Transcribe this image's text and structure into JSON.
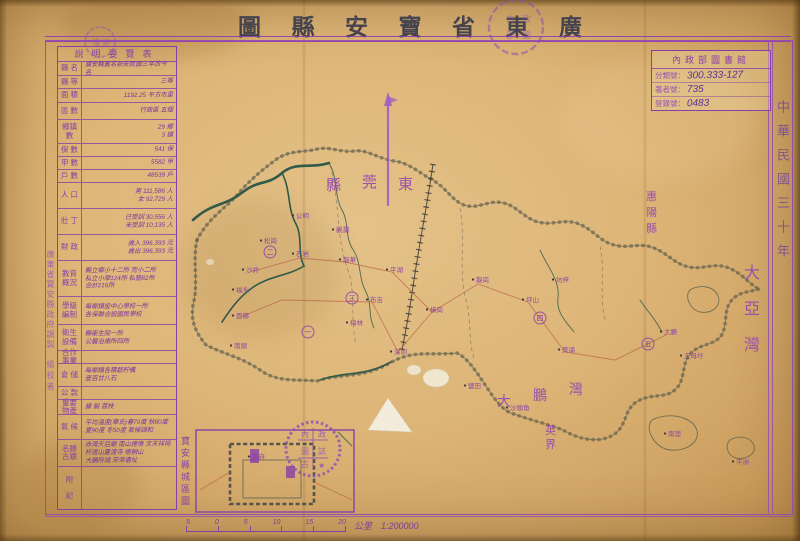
{
  "title": {
    "reading": "廣東省寶安縣圖",
    "display_chars": [
      "圖",
      "縣",
      "安",
      "寶",
      "省",
      "東",
      "廣"
    ]
  },
  "library_card": {
    "header": "內政部圖書館",
    "fields": [
      {
        "label": "分類號：",
        "value": "300.333-127"
      },
      {
        "label": "著者號：",
        "value": "735"
      },
      {
        "label": "登錄號：",
        "value": "0483"
      }
    ]
  },
  "right_margin": {
    "date_vertical": "中華民國三十年"
  },
  "left_margin": {
    "maker_vertical": "廣東省寶安縣政府調製",
    "checker_vertical": "繪校者"
  },
  "info_table": {
    "title": "說明要覽表",
    "rows": [
      {
        "label": "縣 名",
        "h": 14,
        "lines": [
          "寶安縣舊名新安民國三年改今名"
        ]
      },
      {
        "label": "縣 等",
        "h": 13,
        "lines": [
          "三等"
        ],
        "align": "right"
      },
      {
        "label": "面 積",
        "h": 14,
        "lines": [
          "1192.25 平方市里"
        ],
        "align": "right"
      },
      {
        "label": "區 數",
        "h": 17,
        "lines": [
          "行政區 五個"
        ],
        "align": "right"
      },
      {
        "label": "鄉鎮\n數",
        "h": 24,
        "lines": [
          "29 鄉",
          "3 鎮"
        ],
        "align": "right"
      },
      {
        "label": "保 數",
        "h": 13,
        "lines": [
          "541 保"
        ],
        "align": "right"
      },
      {
        "label": "甲 數",
        "h": 13,
        "lines": [
          "5582 甲"
        ],
        "align": "right"
      },
      {
        "label": "戶 數",
        "h": 13,
        "lines": [
          "48539 戶"
        ],
        "align": "right"
      },
      {
        "label": "人 口",
        "h": 26,
        "lines": [
          "男 111,586 人",
          "女 92,729 人"
        ],
        "align": "right"
      },
      {
        "label": "壯 丁",
        "h": 26,
        "lines": [
          "已受訓 30,556 人",
          "未受訓 10,135 人"
        ],
        "align": "right"
      },
      {
        "label": "財 政",
        "h": 26,
        "lines": [
          "歲入 396,393 元",
          "歲出 396,393 元"
        ],
        "align": "right"
      },
      {
        "label": "教育\n概況",
        "h": 36,
        "lines": [
          "縣立鄉小十二所 完小二所",
          "私立小學124所 私塾82所",
          "合計216所"
        ]
      },
      {
        "label": "學級\n編制",
        "h": 28,
        "lines": [
          "每鄉鎮設中心學校一所",
          "各保聯合設國民學校"
        ]
      },
      {
        "label": "衛生\n設備",
        "h": 26,
        "lines": [
          "縣衛生院一所",
          "公醫治療所四所"
        ]
      },
      {
        "label": "合作\n事業",
        "h": 13,
        "lines": [
          ""
        ]
      },
      {
        "label": "倉 儲",
        "h": 23,
        "lines": [
          "每鄉鎮各積穀貯備",
          "壹百廿八石"
        ]
      },
      {
        "label": "公 款",
        "h": 13,
        "lines": [
          ""
        ]
      },
      {
        "label": "重要\n物產",
        "h": 15,
        "lines": [
          "蠔 蝦 荔枝"
        ]
      },
      {
        "label": "氣 候",
        "h": 25,
        "lines": [
          "平均溫度(華氏)春70度 秋80度",
          "夏90度 冬50度 氣候調和"
        ]
      },
      {
        "label": "名勝\n古蹟",
        "h": 27,
        "lines": [
          "赤灣天后廟 南山煙墩 文天祥祠",
          "杯渡山靈渡寺 梧桐山",
          "大鵬所城 宋帝遺址"
        ]
      },
      {
        "label": "附\n\n記",
        "h": 0,
        "lines": [
          ""
        ]
      }
    ]
  },
  "inset": {
    "label_vertical": "寶安縣城區圖"
  },
  "scale_bar": {
    "ticks": [
      "5",
      "0",
      "5",
      "10",
      "15",
      "20"
    ],
    "unit_and_ratio": "公里　1:200000"
  },
  "stamps": {
    "title_stamp_chars": [
      "內",
      "政",
      "部",
      "圖"
    ],
    "header_stamp_chars": [
      "檔",
      "案"
    ],
    "grid_stamp_chars": [
      "內",
      "政",
      "圖",
      "誌",
      "古",
      "★"
    ]
  },
  "map_labels": {
    "large": [
      {
        "t": "縣",
        "x": 326,
        "y": 190,
        "s": 15
      },
      {
        "t": "莞",
        "x": 362,
        "y": 187,
        "s": 15
      },
      {
        "t": "東",
        "x": 398,
        "y": 189,
        "s": 15
      },
      {
        "t": "惠",
        "x": 646,
        "y": 200,
        "s": 11
      },
      {
        "t": "陽",
        "x": 646,
        "y": 216,
        "s": 11
      },
      {
        "t": "縣",
        "x": 646,
        "y": 232,
        "s": 11
      },
      {
        "t": "大",
        "x": 744,
        "y": 278,
        "s": 16
      },
      {
        "t": "亞",
        "x": 744,
        "y": 314,
        "s": 16
      },
      {
        "t": "灣",
        "x": 744,
        "y": 350,
        "s": 16
      },
      {
        "t": "大",
        "x": 497,
        "y": 406,
        "s": 14
      },
      {
        "t": "鵬",
        "x": 533,
        "y": 400,
        "s": 14
      },
      {
        "t": "灣",
        "x": 569,
        "y": 394,
        "s": 14
      },
      {
        "t": "英",
        "x": 545,
        "y": 434,
        "s": 11
      },
      {
        "t": "界",
        "x": 545,
        "y": 448,
        "s": 11
      }
    ],
    "small": [
      {
        "t": "公明",
        "x": 296,
        "y": 218
      },
      {
        "t": "松崗",
        "x": 264,
        "y": 243
      },
      {
        "t": "沙井",
        "x": 246,
        "y": 272
      },
      {
        "t": "福永",
        "x": 236,
        "y": 292
      },
      {
        "t": "西鄉",
        "x": 236,
        "y": 318
      },
      {
        "t": "南頭",
        "x": 234,
        "y": 348
      },
      {
        "t": "石岩",
        "x": 296,
        "y": 256
      },
      {
        "t": "觀瀾",
        "x": 336,
        "y": 232
      },
      {
        "t": "龍華",
        "x": 343,
        "y": 262
      },
      {
        "t": "平湖",
        "x": 390,
        "y": 272
      },
      {
        "t": "布吉",
        "x": 370,
        "y": 302
      },
      {
        "t": "梅林",
        "x": 350,
        "y": 325
      },
      {
        "t": "深圳",
        "x": 394,
        "y": 354
      },
      {
        "t": "橫崗",
        "x": 430,
        "y": 312
      },
      {
        "t": "龍崗",
        "x": 476,
        "y": 282
      },
      {
        "t": "坪山",
        "x": 526,
        "y": 302
      },
      {
        "t": "坑梓",
        "x": 556,
        "y": 282
      },
      {
        "t": "鹽田",
        "x": 468,
        "y": 388
      },
      {
        "t": "沙頭角",
        "x": 510,
        "y": 410
      },
      {
        "t": "葵涌",
        "x": 562,
        "y": 352
      },
      {
        "t": "大鵬",
        "x": 664,
        "y": 334
      },
      {
        "t": "王母圩",
        "x": 684,
        "y": 358
      },
      {
        "t": "南澳",
        "x": 668,
        "y": 436
      },
      {
        "t": "平洲",
        "x": 736,
        "y": 464
      },
      {
        "t": "縣府",
        "x": 252,
        "y": 459
      }
    ],
    "districts": [
      {
        "n": "一",
        "x": 308,
        "y": 332
      },
      {
        "n": "二",
        "x": 270,
        "y": 252
      },
      {
        "n": "三",
        "x": 352,
        "y": 298
      },
      {
        "n": "四",
        "x": 540,
        "y": 318
      },
      {
        "n": "五",
        "x": 648,
        "y": 344
      }
    ]
  }
}
